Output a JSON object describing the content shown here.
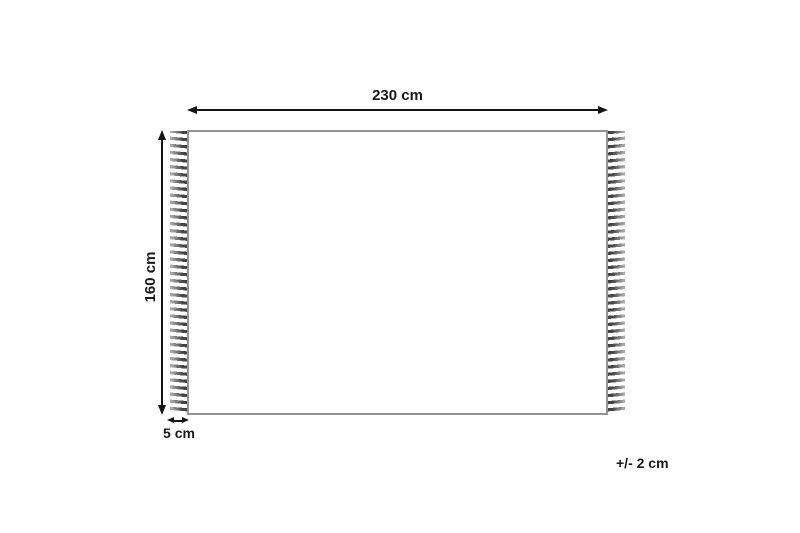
{
  "diagram": {
    "kind": "rug-dimension-diagram",
    "background_color": "#ffffff",
    "rug_outline_color": "#949494",
    "fringe_color": "#3d3d3d",
    "arrow_color": "#141414",
    "text_color": "#1a1a1a",
    "labels": {
      "width": "230 cm",
      "height": "160 cm",
      "fringe": "5 cm",
      "tolerance": "+/- 2 cm"
    }
  }
}
